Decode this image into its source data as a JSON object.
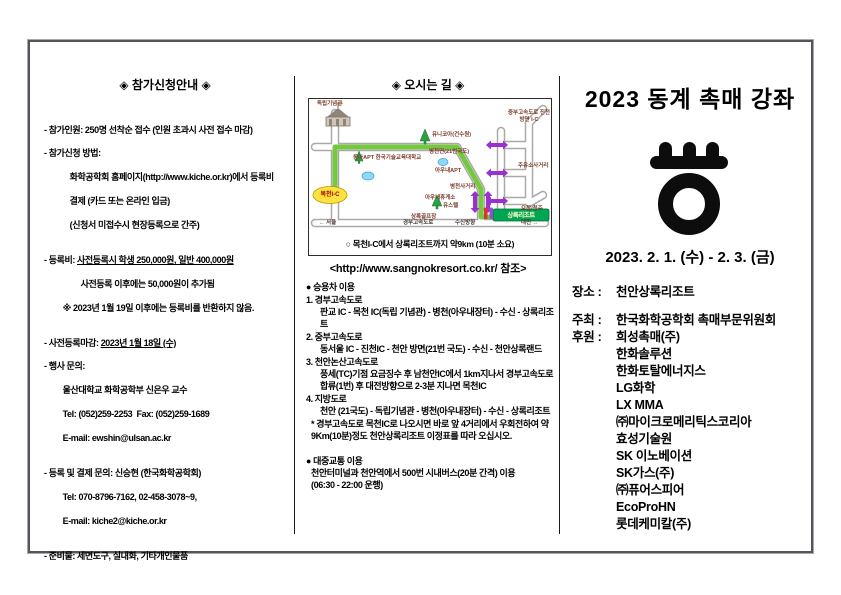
{
  "left": {
    "title": "◈ 참가신청안내 ◈",
    "p1": "- 참가인원: 250명 선착순 접수 (인원 초과시 사전 접수 마감)",
    "p2_l1": "- 참가신청 방법:",
    "p2_l2": "화학공학회 홈페이지(http://www.kiche.or.kr)에서 등록비",
    "p2_l3": "결제 (카드 또는 온라인 입금)",
    "p2_l4": "(신청서 미접수시 현장등록으로 간주)",
    "p3_prefix": "- 등록비: ",
    "p3_underline": "사전등록시 학생 250,000원, 일반 400,000원",
    "p3_l2": "사전등록 이후에는 50,000원이 추가됨",
    "p3_l3": "※ 2023년 1월 19일 이후에는 등록비를 반환하지 않음.",
    "p4_prefix": "- 사전등록마감: ",
    "p4_underline": "2023년 1월 18일 (수)",
    "p5_l1": "- 행사 문의:",
    "p5_l2": "울산대학교 화학공학부 신은우 교수",
    "p5_l3": "Tel: (052)259-2253  Fax: (052)259-1689",
    "p5_l4": "E-mail: ewshin@ulsan.ac.kr",
    "p6_l1": "- 등록 및 결제 문의: 신승현 (한국화학공학회)",
    "p6_l2": "Tel: 070-8796-7162, 02-458-3078~9,",
    "p6_l3": "E-mail: kiche2@kiche.or.kr",
    "p7": "- 준비물: 세면도구, 실내화, 기타개인물품"
  },
  "middle": {
    "title": "◈ 오시는 길 ◈",
    "map": {
      "labels": {
        "independence_hall": "독립기념관",
        "unikoa": "유니코아(건수원)",
        "koreatech": "동아APT 한국기술교육대학교",
        "byeongcheon_road": "병천면(21번국도)",
        "aunae_apt": "아우내APT",
        "jungbu_ic": "중부고속도로 진천 방면 I-C",
        "gas_crossing": "주유소사거리",
        "byeongcheon_crossing": "병천사거리",
        "aunae_rest": "아우내휴게소",
        "youth_hostel": "유스텔",
        "sangnok_golf": "상록골프장",
        "ochang": "오창/청주",
        "mokcheon_ic": "목천I-C",
        "seoul": "← 서울",
        "gyeongbu_expwy": "경부고속도로",
        "susin": "수신방향",
        "daejeon": "대전 →",
        "resort": "상록리조트"
      },
      "caption": "○ 목천I-C에서 상록리조트까지 약9km (10분 소요)",
      "reference": "<http://www.sangnokresort.co.kr/ 참조>"
    },
    "car": {
      "heading": "● 승용차 이용",
      "item1_head": "1. 경부고속도로",
      "item1_body": "판교 IC - 목천 IC(독립 기념관) - 병천(아우내장터) - 수신 - 상록리조트",
      "item2_head": "2. 중부고속도로",
      "item2_body": "동서울 IC - 진천IC - 천안 방면(21번 국도) - 수신 - 천안상록랜드",
      "item3_head": "3. 천안논산고속도로",
      "item3_body": "풍세(TC)기점 요금징수 후 남천안IC에서 1km지나서 경부고속도로 합류(1번) 후 대전방향으로 2-3분 지나면 목천IC",
      "item4_head": "4. 지방도로",
      "item4_body": "천안 (21국도) - 독립기념관 - 병천(아우내장터) - 수신 - 상록리조트",
      "note": "* 경부고속도로 목천IC로 나오시면 바로 앞 4거리에서 우회전하여 약 9Km(10분)정도 천안상록리조트 이정표를 따라 오십시오."
    },
    "transit": {
      "heading": "● 대중교통 이용",
      "body1": "천안터미널과 천안역에서 500번 시내버스(20분 간격) 이용",
      "body2": "(06:30 - 22:00 운행)"
    }
  },
  "right": {
    "title": "2023 동계 촉매 강좌",
    "date": "2023. 2. 1. (수) - 2. 3. (금)",
    "venue_label": "장소 :",
    "venue": "천안상록리조트",
    "host_label": "주최 :",
    "host": "한국화학공학회 촉매부문위원회",
    "sponsor_label": "후원 :",
    "sponsors": [
      "희성촉매(주)",
      "한화솔루션",
      "한화토탈에너지스",
      "LG화학",
      "LX MMA",
      "㈜마이크로메리틱스코리아",
      "효성기술원",
      "SK 이노베이션",
      "SK가스(주)",
      "㈜퓨어스피어",
      "EcoProHN",
      "롯데케미칼(주)"
    ]
  }
}
